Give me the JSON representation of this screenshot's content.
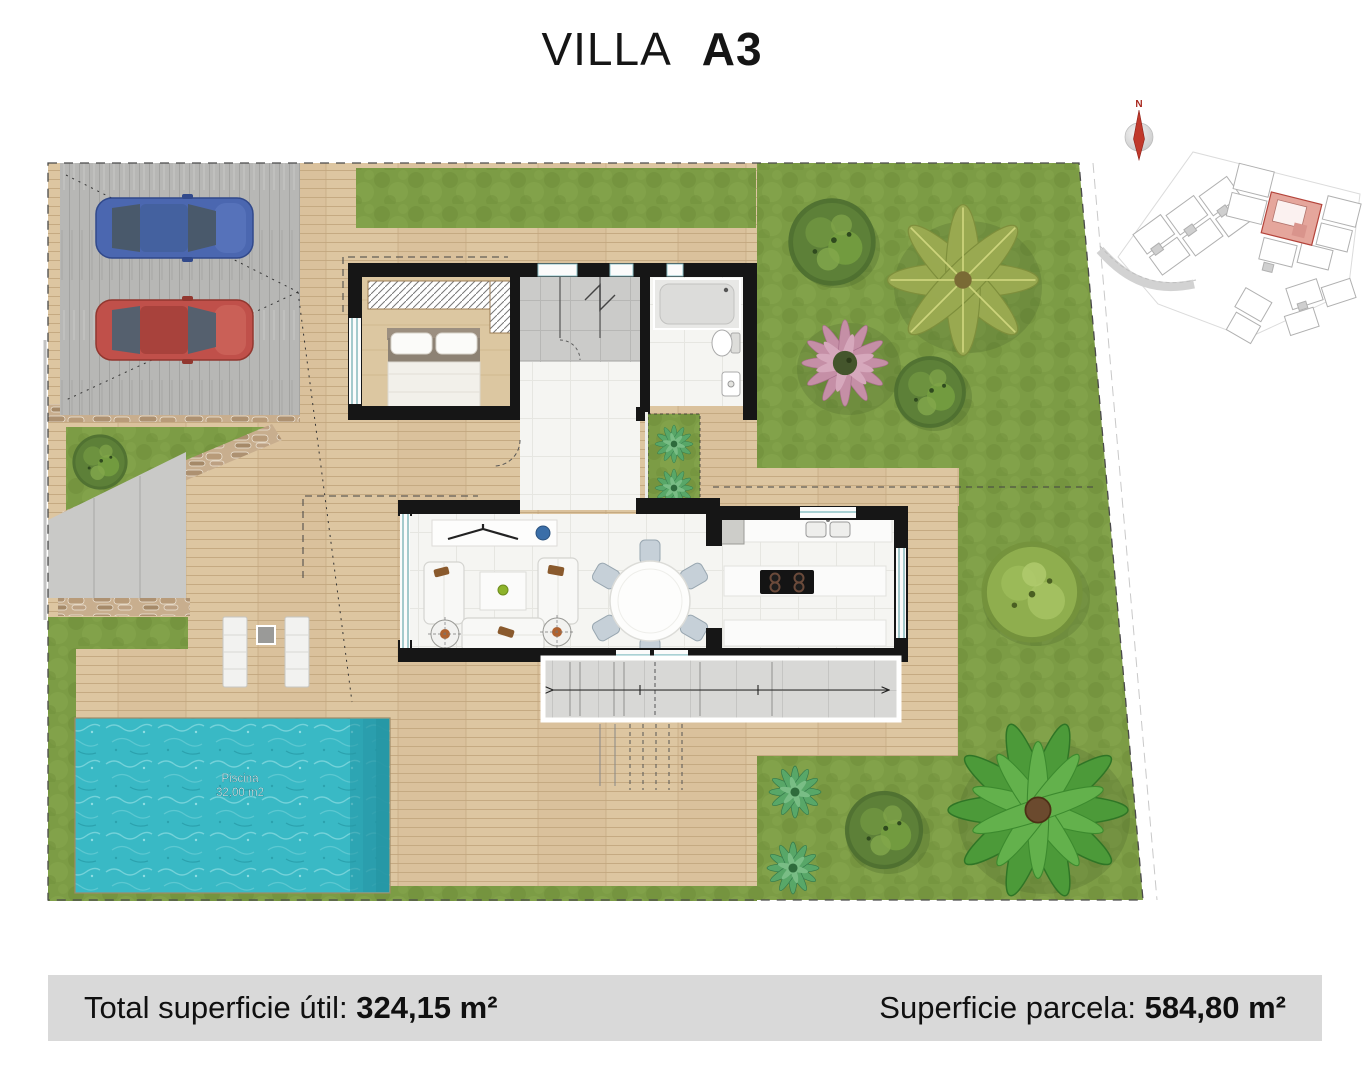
{
  "title": {
    "name": "VILLA",
    "unit": "A3"
  },
  "compass": {
    "north_label": "N"
  },
  "plan": {
    "pool_label_line1": "Piscina",
    "pool_label_line2": "32,00 m2"
  },
  "footer": {
    "left_label": "Total superficie útil: ",
    "left_value": "324,15 m²",
    "right_label": "Superficie parcela: ",
    "right_value": "584,80 m²"
  },
  "colors": {
    "grass": "#7c9c45",
    "grass_dark": "#6d8c3a",
    "grass_light": "#8aa851",
    "deck": "#dac19c",
    "deck_line": "#c2a67e",
    "parking": "#b7b7b5",
    "pool": "#39b9c5",
    "pool_dark": "#2596a4",
    "wall": "#161616",
    "stone": "#c8ae8e",
    "terrace": "#d8d8d6",
    "tile_gray": "#cbcbc9",
    "floor_white": "#f5f5f2",
    "car_blue": "#4b67b0",
    "car_red": "#c0504a",
    "footer_bg": "#d9d9d9",
    "highlight": "#e5a69c",
    "compass_red": "#c0392b",
    "text": "#111111"
  }
}
